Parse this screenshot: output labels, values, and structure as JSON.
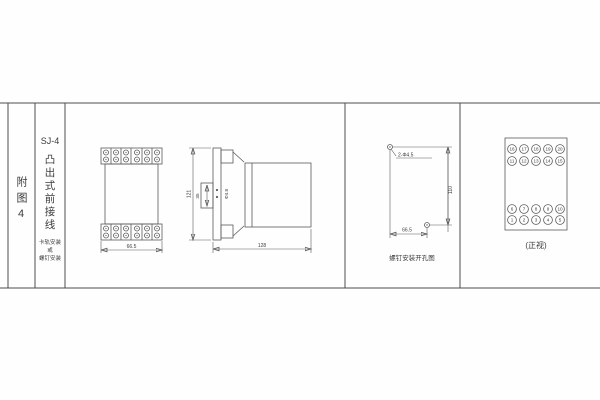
{
  "colors": {
    "line": "#5a5a5a",
    "text": "#3c3c3c",
    "background": "#fefefe"
  },
  "title_block": {
    "fig_label": "附图4",
    "model": "SJ-4",
    "title_vertical": "凸出式前接线",
    "mount_line1": "卡轨安装",
    "mount_line2": "或",
    "mount_line3": "螺钉安装"
  },
  "front_view": {
    "width_dim": "66.5"
  },
  "side_view": {
    "height_dim": "121",
    "slot_dim": "35",
    "hole_dim": "Φ4.8",
    "depth_dim": "128"
  },
  "drill_view": {
    "holes_label": "2-Φ4.5",
    "height_dim": "110",
    "width_dim": "66.5",
    "caption": "螺钉安装开孔图"
  },
  "terminal_view": {
    "caption": "(正视)",
    "rows": [
      [
        "16",
        "17",
        "18",
        "19",
        "20"
      ],
      [
        "11",
        "12",
        "13",
        "14",
        "15"
      ],
      [
        "6",
        "7",
        "8",
        "9",
        "10"
      ],
      [
        "1",
        "2",
        "3",
        "4",
        "5"
      ]
    ]
  }
}
